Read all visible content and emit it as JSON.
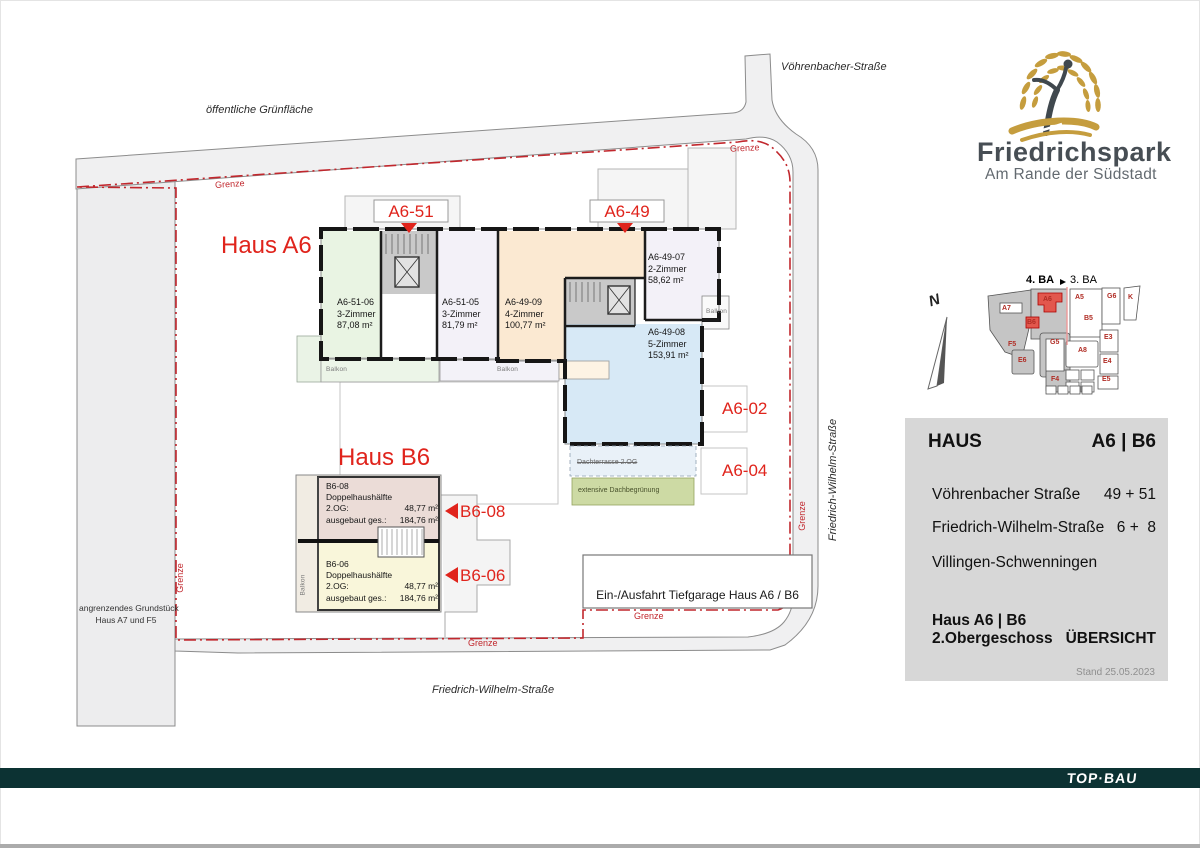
{
  "logo": {
    "brand": "Friedrichspark",
    "tagline": "Am Rande der Südstadt"
  },
  "labels": {
    "gruenflaeche": "öffentliche Grünfläche",
    "voehrenbacher": "Vöhrenbacher-Straße",
    "friedrich_wilhelm": "Friedrich-Wilhelm-Straße",
    "grenze": "Grenze",
    "angrenzend1": "angrenzendes Grundstück",
    "angrenzend2": "Haus  A7 und F5",
    "tiefgarage": "Ein-/Ausfahrt Tiefgarage Haus A6 / B6",
    "balkon": "Balkon",
    "dachterrasse": "Dachterrasse 2.OG",
    "dachbegruenung": "extensive Dachbegrünung"
  },
  "haus_a6": {
    "title": "Haus A6",
    "entrance_51": "A6-51",
    "entrance_49": "A6-49",
    "ref_02": "A6-02",
    "ref_04": "A6-04",
    "apartments": [
      {
        "id": "A6-51-06",
        "rooms": "3-Zimmer",
        "area": "87,08 m²"
      },
      {
        "id": "A6-51-05",
        "rooms": "3-Zimmer",
        "area": "81,79 m²"
      },
      {
        "id": "A6-49-09",
        "rooms": "4-Zimmer",
        "area": "100,77 m²"
      },
      {
        "id": "A6-49-07",
        "rooms": "2-Zimmer",
        "area": "58,62 m²"
      },
      {
        "id": "A6-49-08",
        "rooms": "5-Zimmer",
        "area": "153,91 m²"
      }
    ]
  },
  "haus_b6": {
    "title": "Haus B6",
    "ref_08": "B6-08",
    "ref_06": "B6-06",
    "units": [
      {
        "id": "B6-08",
        "type": "Doppelhaushälfte",
        "floor_label": "2.OG:",
        "floor_area": "48,77 m²",
        "total_label": "ausgebaut ges.:",
        "total_area": "184,76 m²"
      },
      {
        "id": "B6-06",
        "type": "Doppelhaushälfte",
        "floor_label": "2.OG:",
        "floor_area": "48,77 m²",
        "total_label": "ausgebaut ges.:",
        "total_area": "184,76 m²"
      }
    ]
  },
  "minimap": {
    "ba4": "4. BA",
    "ba3": "3. BA",
    "north": "N",
    "buildings": [
      "A7",
      "A6",
      "B6",
      "F5",
      "E6",
      "G5",
      "F4",
      "A5",
      "B5",
      "G6",
      "K",
      "A8",
      "E3",
      "E4",
      "E5"
    ]
  },
  "info_panel": {
    "haus_label": "HAUS",
    "haus_value": "A6 | B6",
    "address1_label": "Vöhrenbacher Straße",
    "address1_value": "49 + 51",
    "address2_label": "Friedrich-Wilhelm-Straße",
    "address2_value": "6 +  8",
    "city": "Villingen-Schwenningen",
    "subject1": "Haus A6 | B6",
    "subject2": "2.Obergeschoss",
    "view": "ÜBERSICHT",
    "stand": "Stand 25.05.2023"
  },
  "footer": {
    "brand": "TOP·BAU"
  }
}
